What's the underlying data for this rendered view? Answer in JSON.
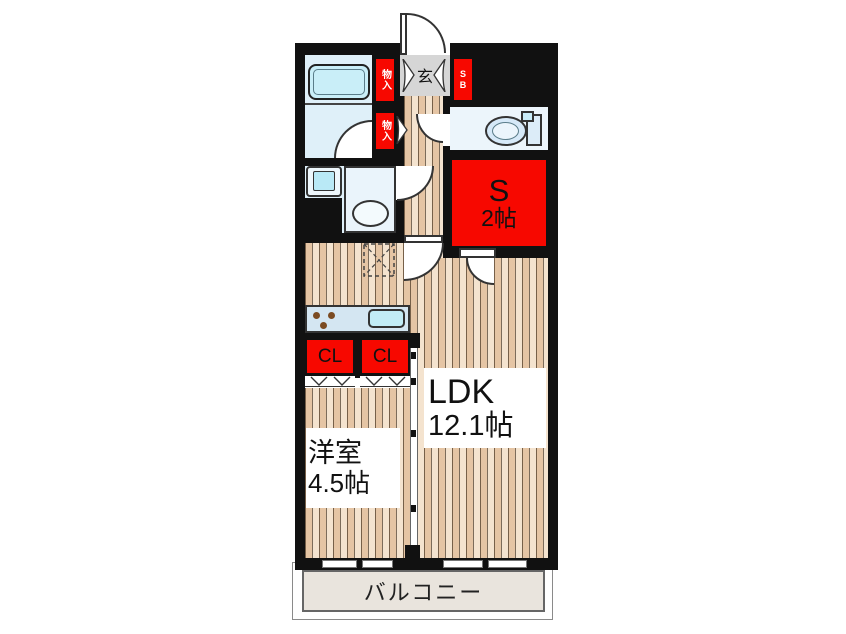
{
  "plan": {
    "entrance_label": "玄",
    "shoebox_label": "SB",
    "storage_upper_label": "物入",
    "storage_lower_label": "物入",
    "service_room": {
      "name": "S",
      "area": "2帖"
    },
    "ldk": {
      "name": "LDK",
      "area": "12.1帖"
    },
    "western_room": {
      "name": "洋室",
      "area": "4.5帖"
    },
    "closet_left_label": "CL",
    "closet_right_label": "CL",
    "balcony_label": "バルコニー"
  },
  "colors": {
    "wall": "#111111",
    "accent_red": "#f70800",
    "wood_floor": "#f0d8bc",
    "wet_area_floor": "#dff0f9",
    "fixture_blue": "#c9eef8",
    "entrance_tile": "#d6d6d6",
    "balcony_floor": "#e9e4dd"
  }
}
